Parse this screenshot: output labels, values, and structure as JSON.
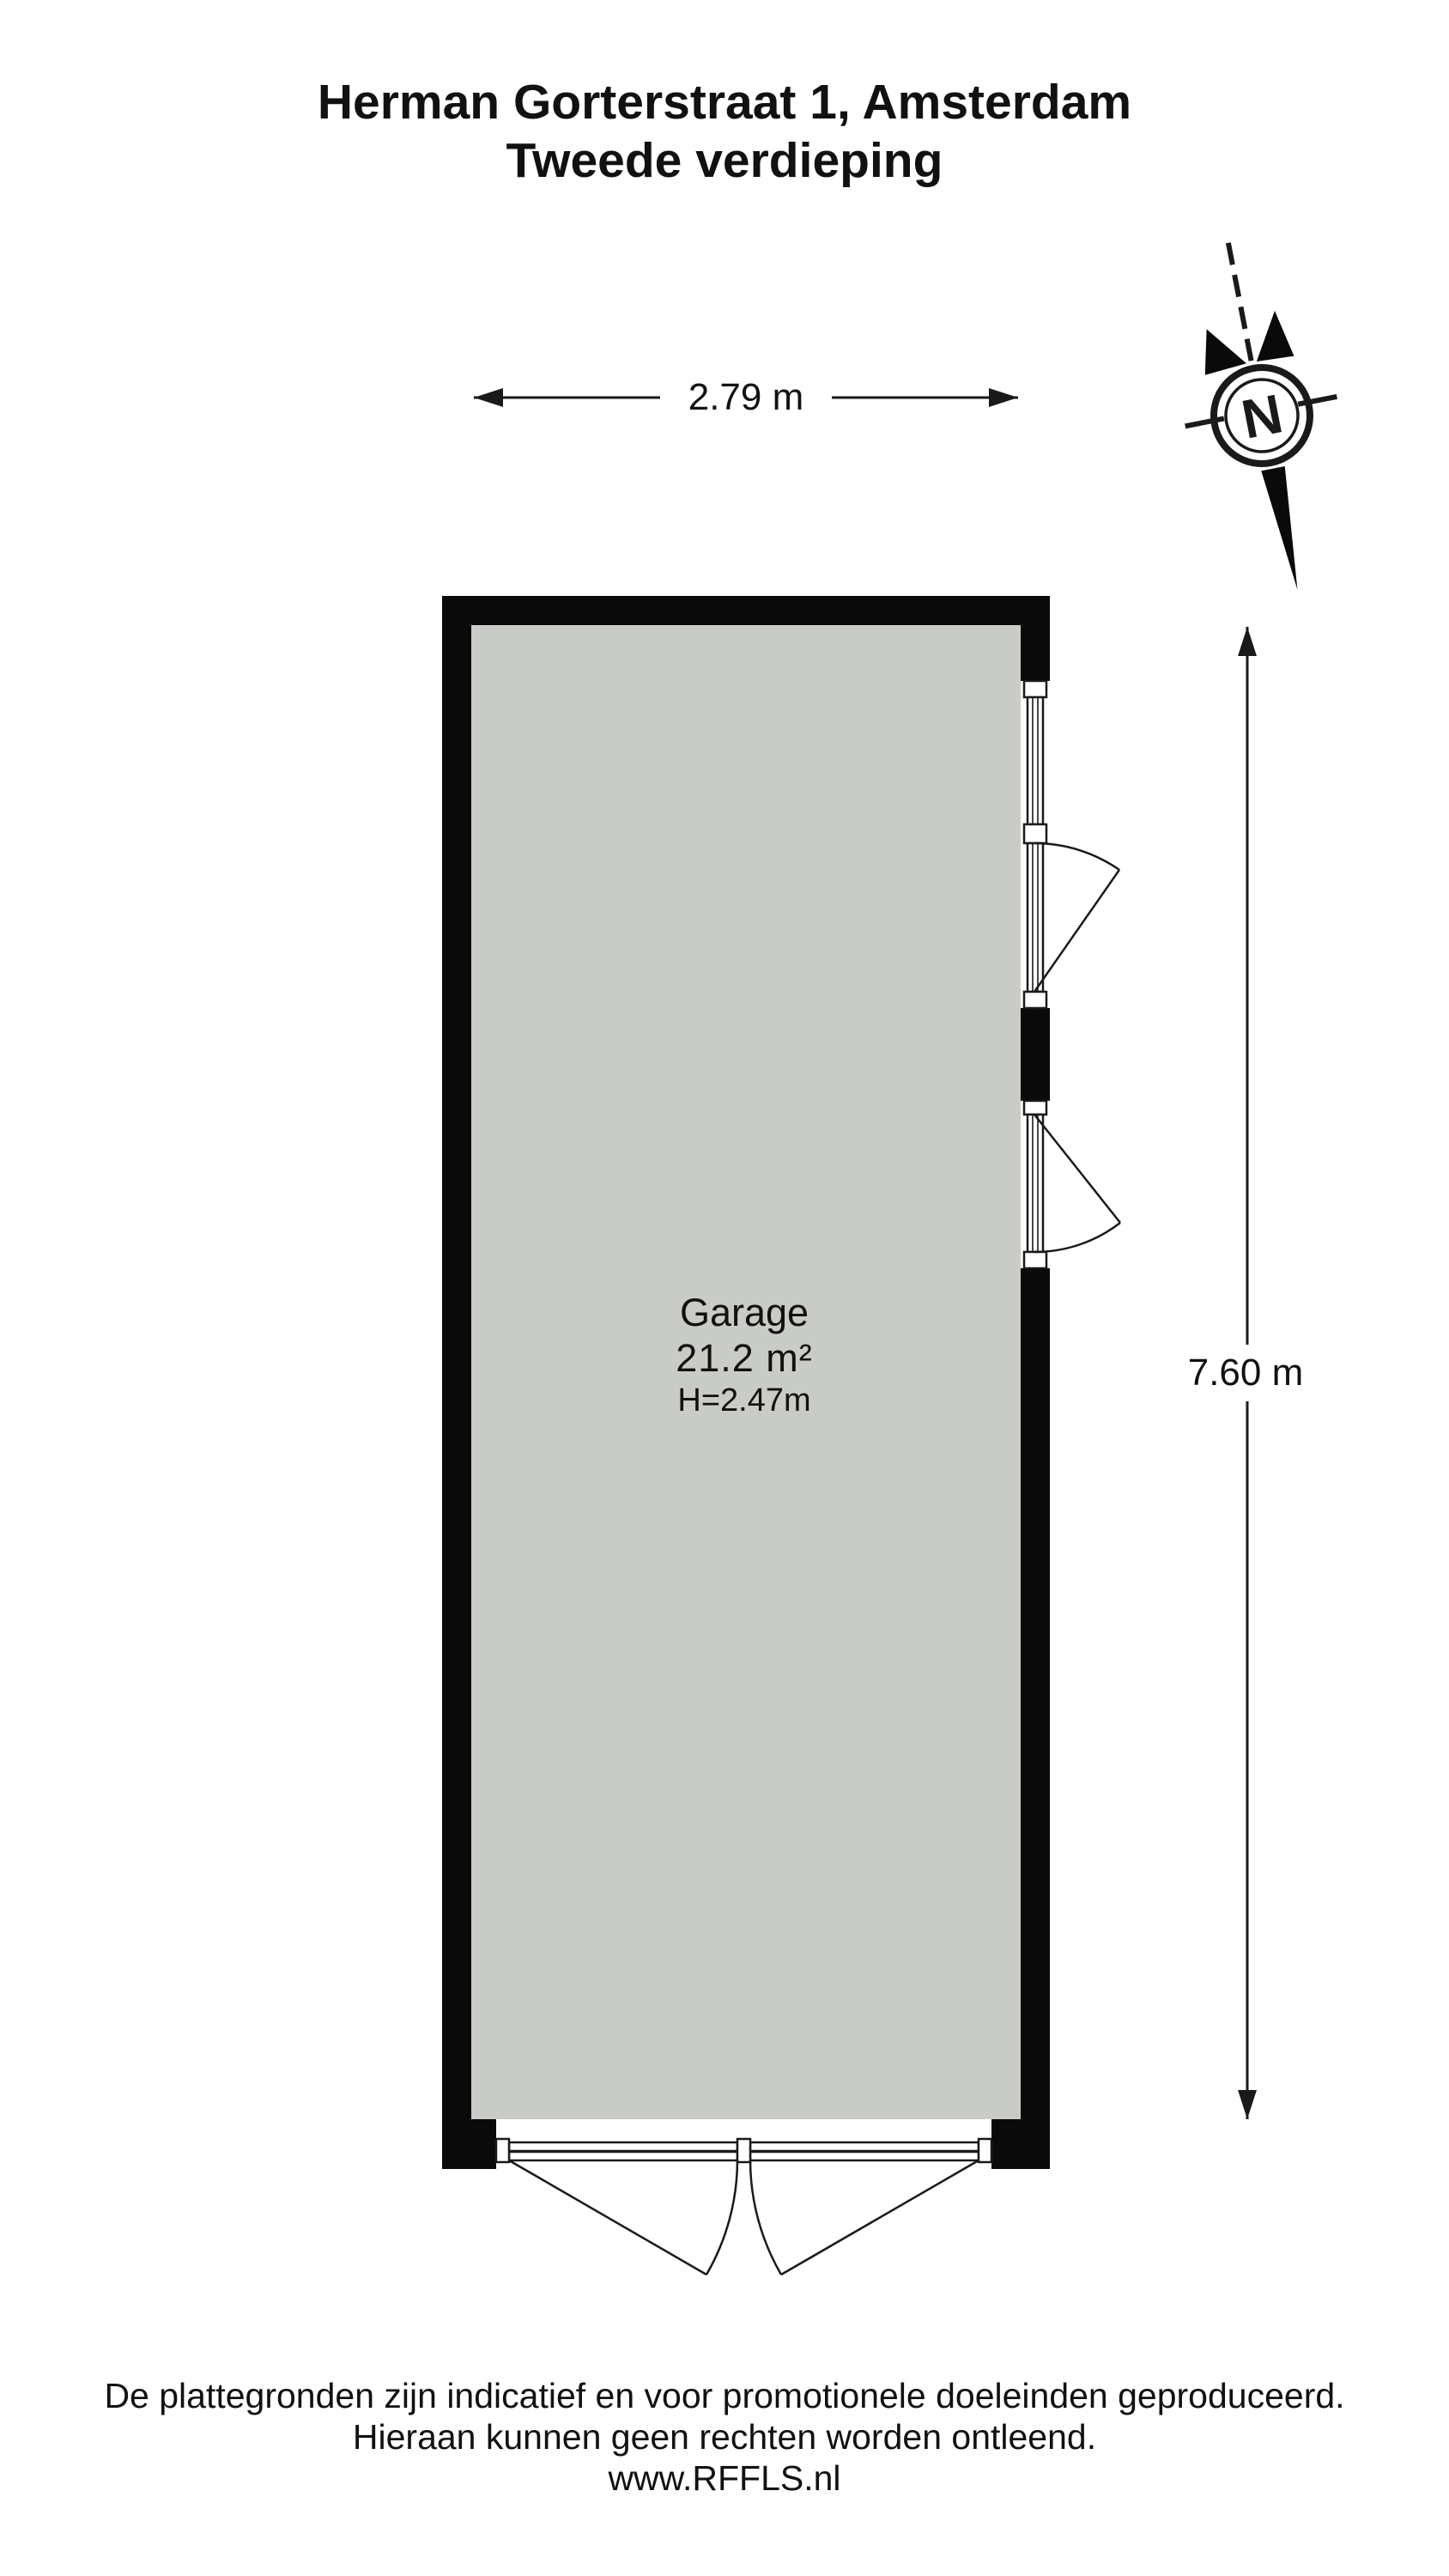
{
  "title": {
    "line1": "Herman Gorterstraat 1, Amsterdam",
    "line2": "Tweede verdieping"
  },
  "compass": {
    "label": "N"
  },
  "dimensions": {
    "width_label": "2.79 m",
    "height_label": "7.60 m"
  },
  "room": {
    "name": "Garage",
    "area": "21.2 m²",
    "ceiling_height": "H=2.47m"
  },
  "footer": {
    "line1": "De plattegronden zijn indicatief en voor promotionele doeleinden geproduceerd.",
    "line2": "Hieraan kunnen geen rechten worden ontleend.",
    "line3": "www.RFFLS.nl"
  },
  "colors": {
    "wall": "#0a0a0a",
    "floor": "#c9ccc6",
    "line": "#1a1a1a",
    "background": "#ffffff"
  }
}
